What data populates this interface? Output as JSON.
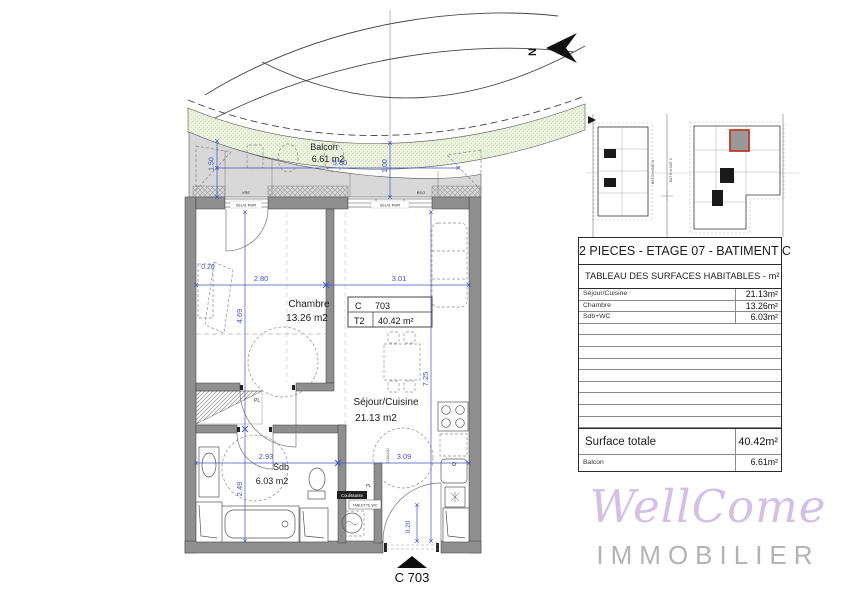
{
  "plan": {
    "north_label": "N",
    "balcony": {
      "name": "Balcon",
      "area": "6.61 m2",
      "dim_depth_left": "1.50",
      "dim_width": "5.80",
      "dim_depth_mid": "1.00"
    },
    "chambre": {
      "name": "Chambre",
      "area": "13.26 m2",
      "dim_wall": "0.20",
      "dim_width": "2.80",
      "dim_height": "4.69"
    },
    "sejour": {
      "name": "Séjour/Cuisine",
      "area": "21.13 m2",
      "dim_width": "3.01",
      "dim_height": "7.25",
      "dim_lower": "3.09",
      "bed_size": "120x220"
    },
    "sdb": {
      "name": "Sdb",
      "area": "6.03 m2",
      "dim_width": "2.93",
      "dim_height": "2.49"
    },
    "entrance": {
      "dim": "0.20",
      "marker_label": "C 703"
    },
    "unit_box": {
      "col1": "C",
      "col2": "703",
      "type": "T2",
      "area": "40.42 m²"
    },
    "wall_labels": {
      "vre": "VRE",
      "seuil_left": "SEUIL PMR",
      "seuil_right": "SEUIL PMR",
      "bso": "BSO"
    },
    "small_labels": {
      "pl_top": "PL",
      "pl_wc": "PL",
      "tablette": "TABLETTE WC",
      "coulissante": "Coulissante"
    },
    "keyplan": {
      "label_left": "BAT B et BAT A",
      "label_right": "BAT B et BAT C"
    }
  },
  "panel": {
    "title": "2 PIECES - ETAGE 07 - BATIMENT C",
    "table_header": "TABLEAU DES SURFACES HABITABLES - m²",
    "rows": [
      {
        "label": "Séjour/Cuisine",
        "value": "21.13m²"
      },
      {
        "label": "Chambre",
        "value": "13.26m²"
      },
      {
        "label": "Sdb+WC",
        "value": "6.03m²"
      }
    ],
    "total": {
      "label": "Surface totale",
      "value": "40.42m²"
    },
    "balcon": {
      "label": "Balcon",
      "value": "6.61m²"
    }
  },
  "logo": {
    "name": "WellCome",
    "subtitle": "IMMOBILIER"
  },
  "colors": {
    "dim_blue": "#4053c8",
    "wall_gray": "#8f8f8f",
    "balcony_gray": "#d8d8d8",
    "green_band": "#eef3e2",
    "highlight_red": "#c23b22",
    "logo_purple": "#c5a8db",
    "logo_gray": "#b5b2b7"
  }
}
